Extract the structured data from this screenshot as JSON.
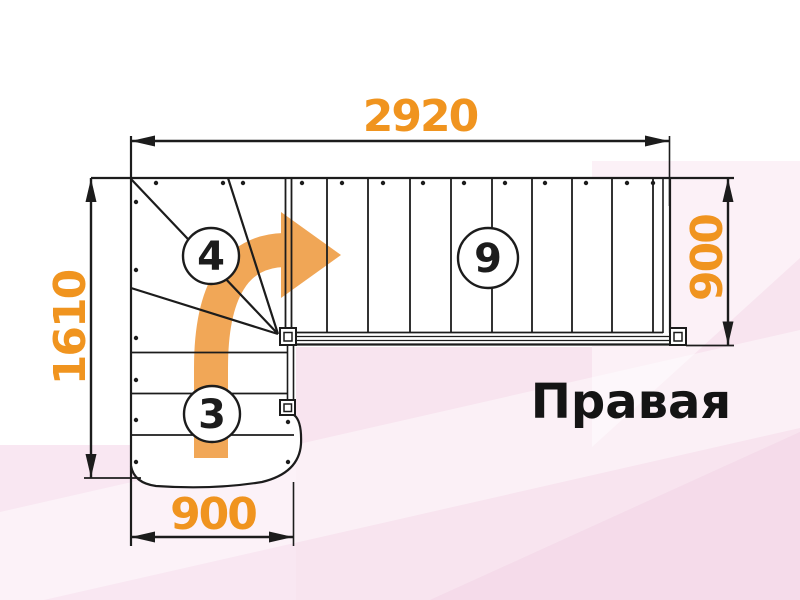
{
  "diagram": {
    "type": "stair-plan-drawing",
    "title": "Правая",
    "dimensions": {
      "top": "2920",
      "left": "1610",
      "right": "900",
      "bottom": "900"
    },
    "step_counts": {
      "winder": "4",
      "upper_flight": "9",
      "lower_flight": "3"
    },
    "colors": {
      "dimension_text": "#F0941F",
      "arrow": "#F0A24E",
      "line": "#1C1C1C",
      "pink": "#F8E4EF",
      "title": "#141414"
    }
  }
}
